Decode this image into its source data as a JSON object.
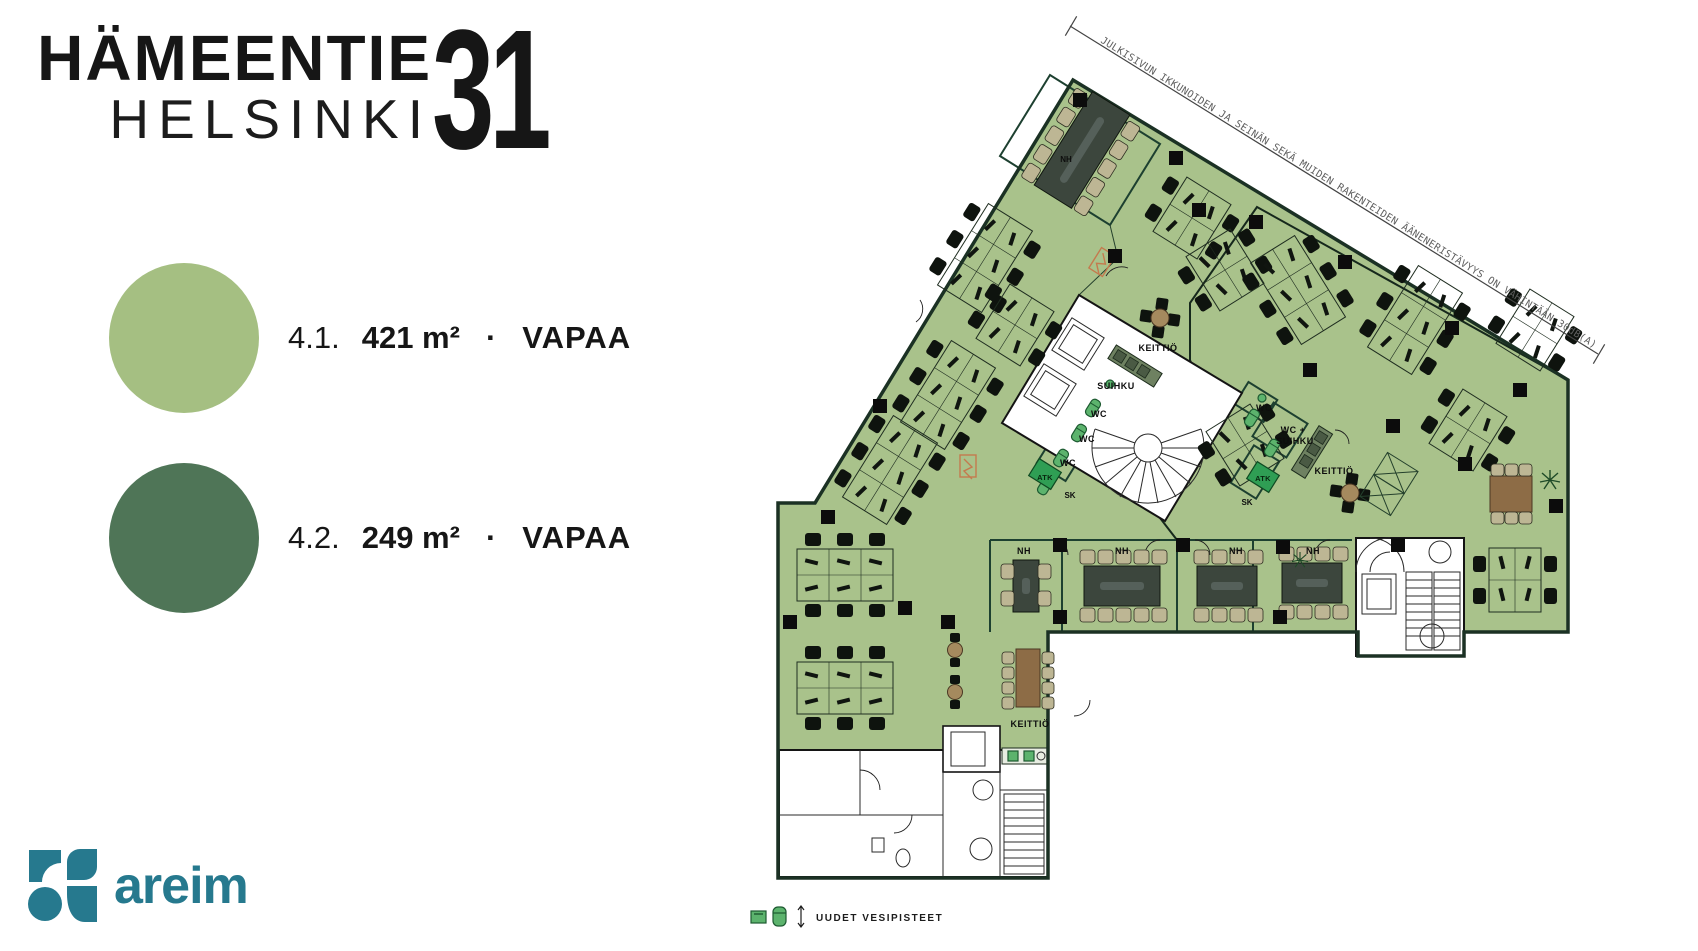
{
  "title": {
    "name": "HÄMEENTIE",
    "city": "HELSINKI",
    "number": "31"
  },
  "units": [
    {
      "id": "4.1.",
      "area": "421 m²",
      "separator": "·",
      "status": "VAPAA",
      "color": "#a5bf82"
    },
    {
      "id": "4.2.",
      "area": "249 m²",
      "separator": "·",
      "status": "VAPAA",
      "color": "#4f7557"
    }
  ],
  "logo": {
    "text": "areim",
    "color": "#26798e"
  },
  "plan": {
    "annotation": "JULKISIVUN IKKUNOIDEN JA SEINÄN SEKÄ MUIDEN RAKENTEIDEN ÄÄNENERISTÄVYYS ON VÄHINTÄÄN 30dB(A)",
    "legend_note": "UUDET VESIPISTEET",
    "colors": {
      "zone_41": "#a9c28b",
      "zone_42": "#577c5e"
    },
    "rooms": [
      {
        "label": "NH"
      },
      {
        "label": "KEITTIÖ"
      },
      {
        "label": "SUIHKU"
      },
      {
        "label": "WC"
      },
      {
        "label": "WC"
      },
      {
        "label": "WC"
      },
      {
        "label": "ATK"
      },
      {
        "label": "SK"
      },
      {
        "label": "NH"
      },
      {
        "label": "NH"
      },
      {
        "label": "NH"
      },
      {
        "label": "NH"
      },
      {
        "label": "WC"
      },
      {
        "label": "WC +"
      },
      {
        "label": "SUIHKU"
      },
      {
        "label": "KEITTIÖ"
      },
      {
        "label": "ATK"
      },
      {
        "label": "SK"
      },
      {
        "label": "KEITTIÖ"
      }
    ]
  }
}
